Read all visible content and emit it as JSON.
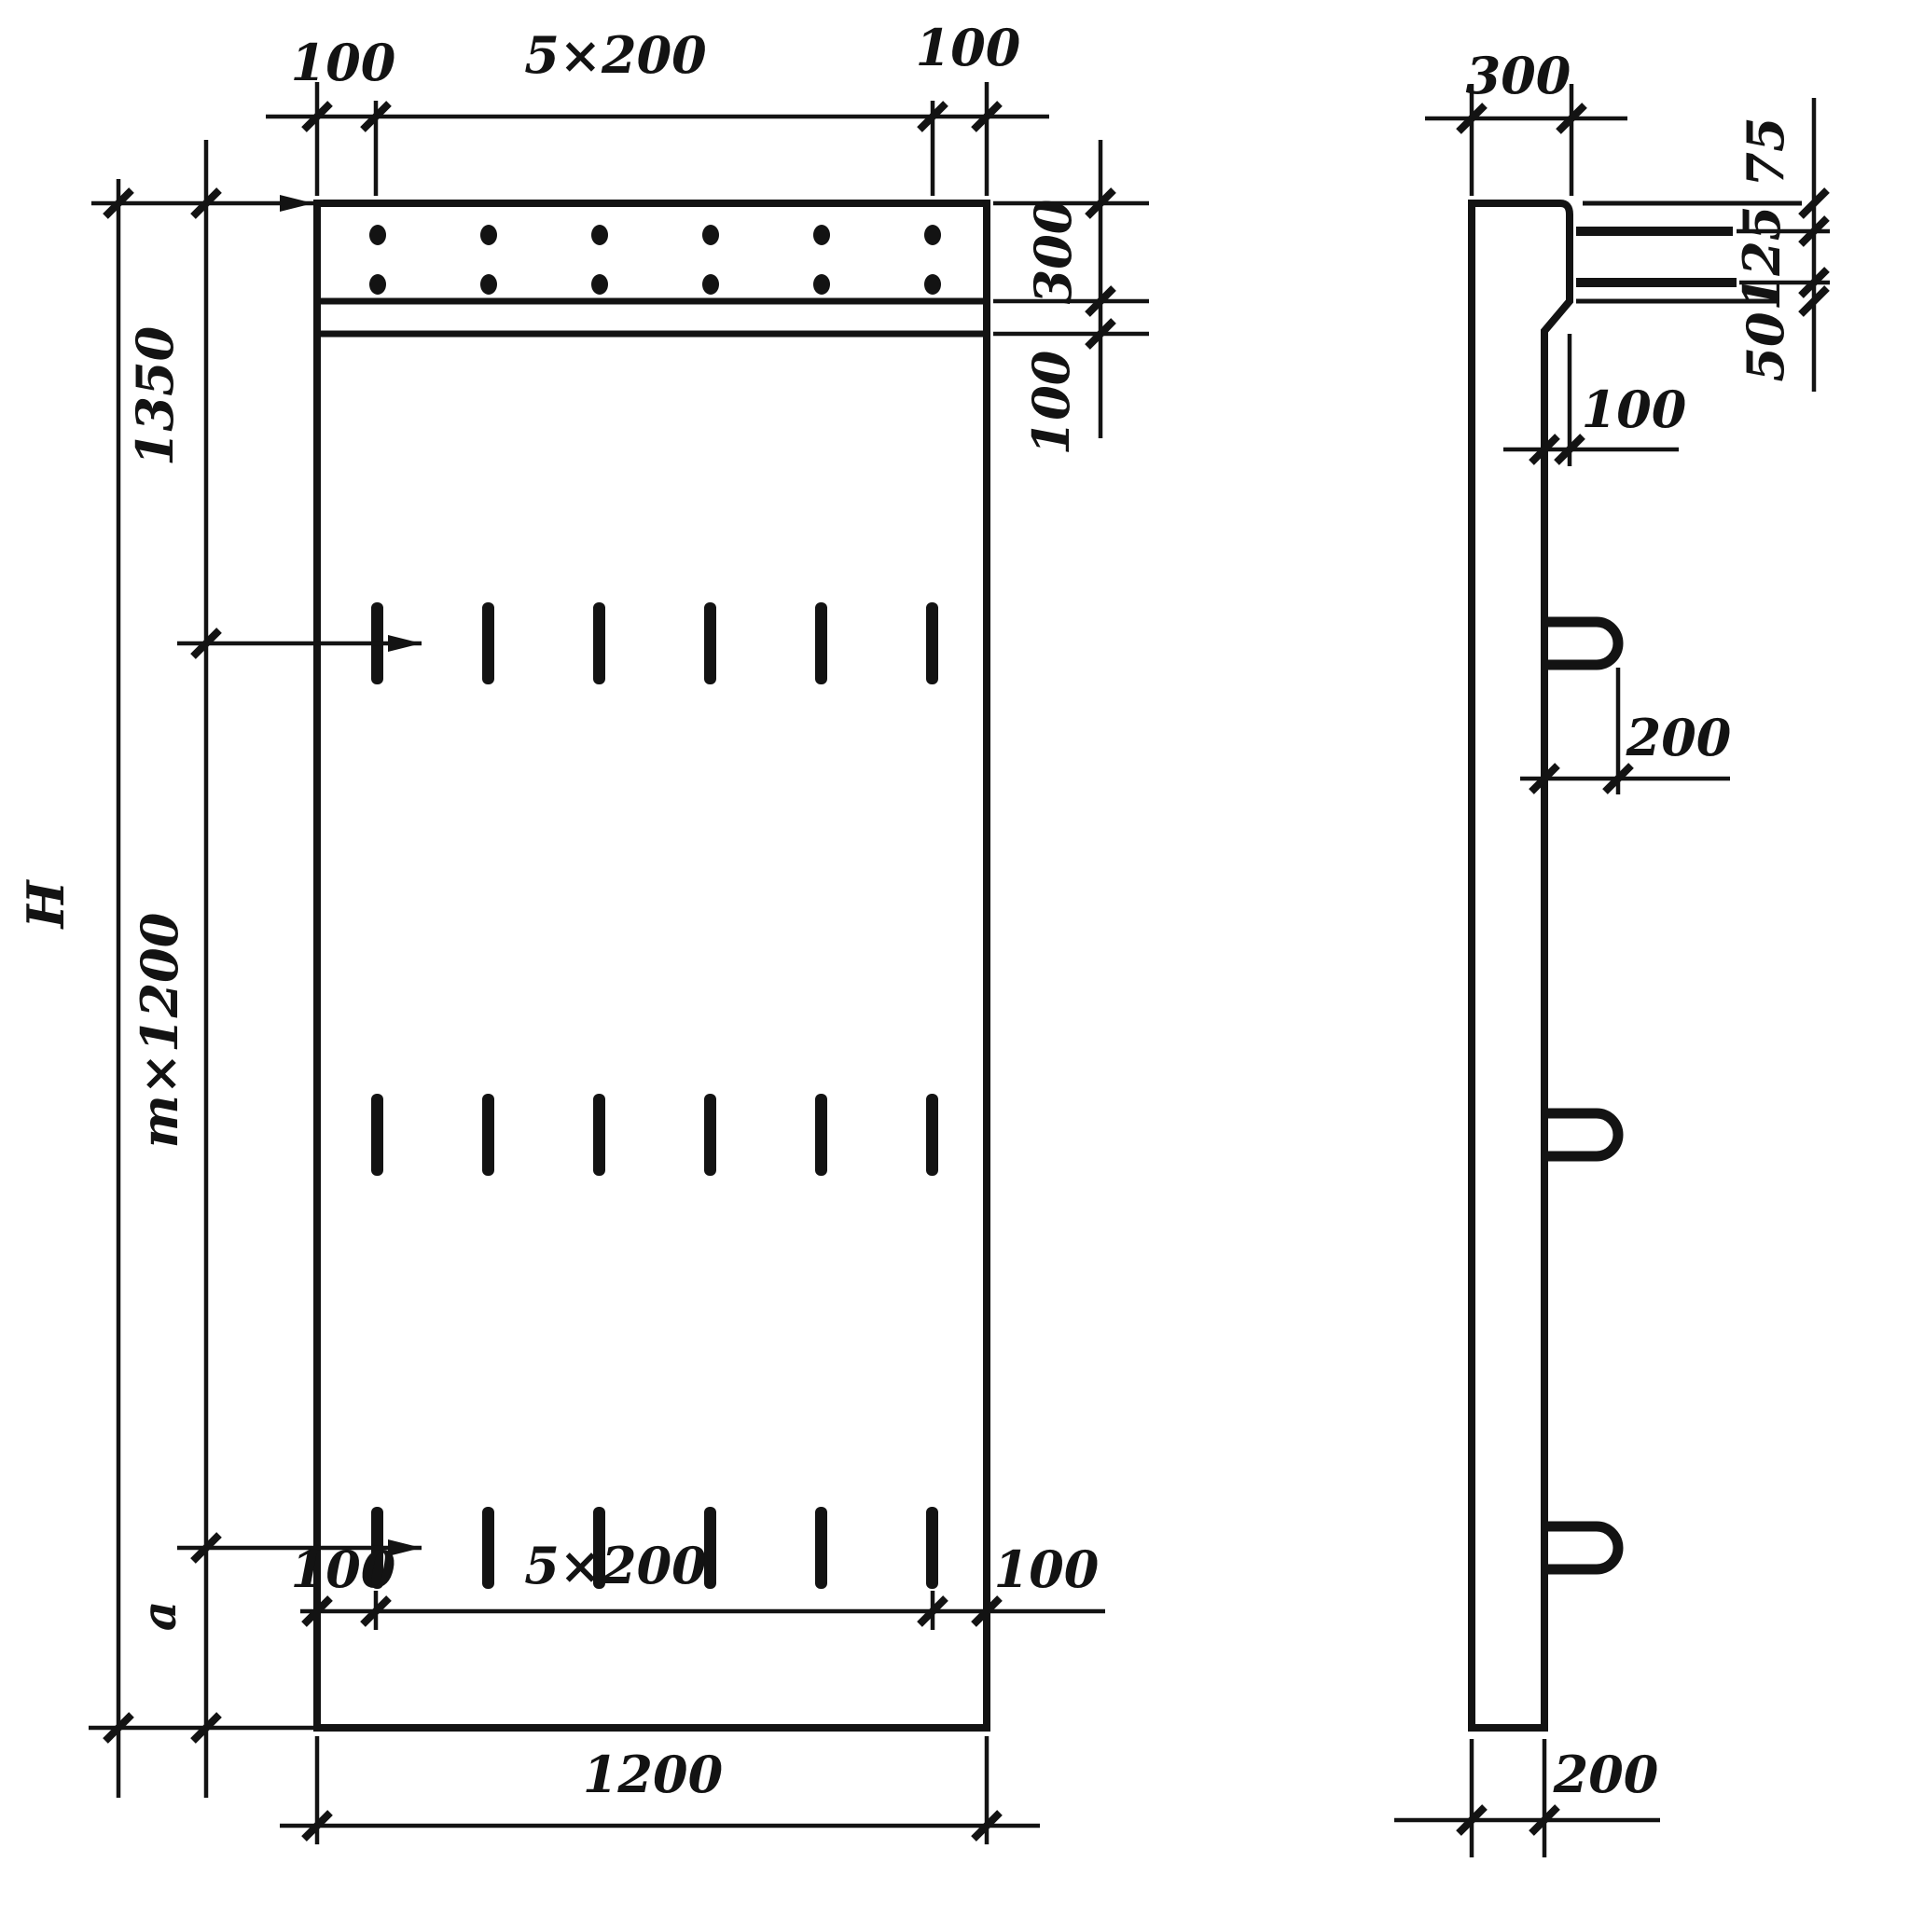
{
  "drawing": {
    "kind": "reinforced concrete panel dimension drawing",
    "units": "mm",
    "front_view": {
      "dims": {
        "top_offset_left": "100",
        "top_spacing": "5×200",
        "top_offset_right": "100",
        "band_height": "300",
        "band_gap": "100",
        "top_to_first_row": "1350",
        "middle_spacing": "m×1200",
        "bottom_segment": "a",
        "total_height": "H",
        "bottom_offset_left": "100",
        "bottom_spacing": "5×200",
        "bottom_offset_right": "100",
        "overall_width": "1200"
      }
    },
    "side_view": {
      "dims": {
        "top_width": "300",
        "ledge_top": "75",
        "ledge_middle": "125",
        "ledge_bottom": "50",
        "console_depth": "100",
        "hook_length": "200",
        "base_thickness": "200"
      }
    }
  }
}
